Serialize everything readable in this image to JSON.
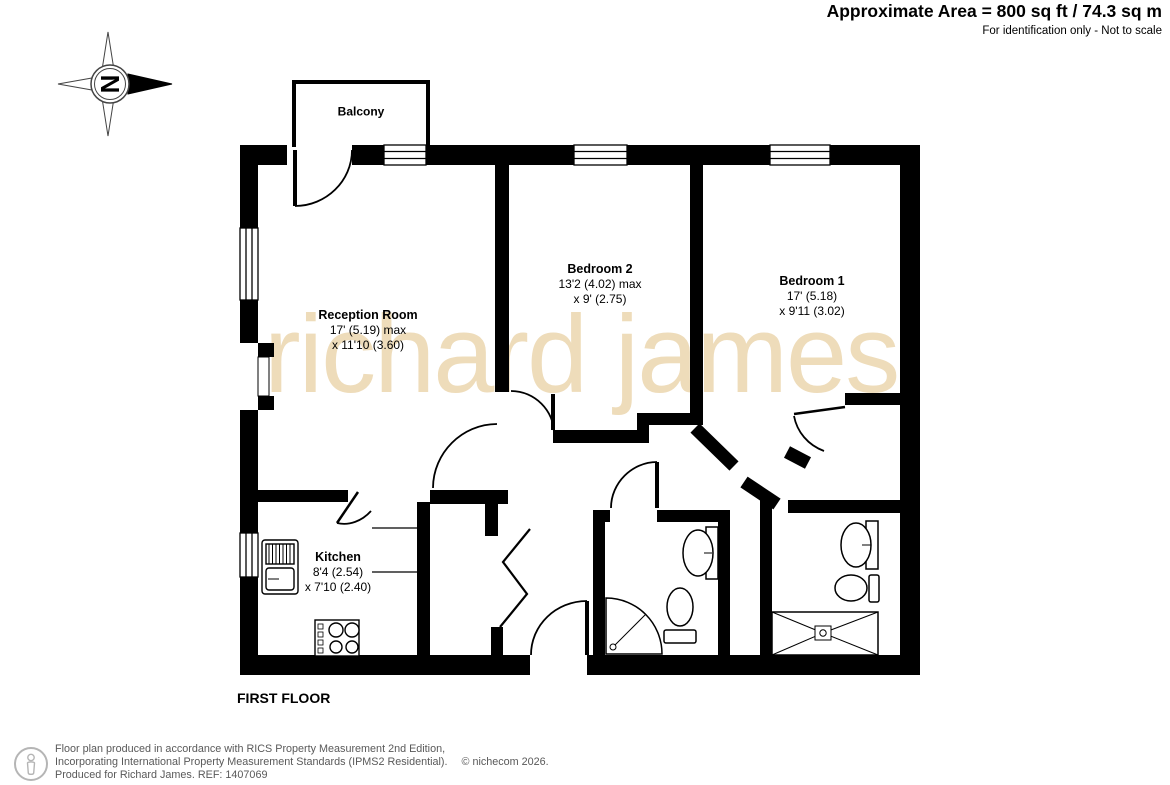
{
  "header": {
    "area_line": "Approximate Area = 800 sq ft / 74.3 sq m",
    "disclaimer": "For identification only - Not to scale"
  },
  "compass": {
    "north_label": "N"
  },
  "watermark": "richard james",
  "floor_label": "FIRST FLOOR",
  "rooms": [
    {
      "name": "Balcony",
      "dim1": "",
      "dim2": ""
    },
    {
      "name": "Reception Room",
      "dim1": "17' (5.19) max",
      "dim2": "x 11'10 (3.60)"
    },
    {
      "name": "Bedroom 2",
      "dim1": "13'2 (4.02) max",
      "dim2": "x 9' (2.75)"
    },
    {
      "name": "Bedroom 1",
      "dim1": "17' (5.18)",
      "dim2": "x 9'11 (3.02)"
    },
    {
      "name": "Kitchen",
      "dim1": "8'4 (2.54)",
      "dim2": "x 7'10 (2.40)"
    }
  ],
  "footer": {
    "line1": "Floor plan produced in accordance with RICS Property Measurement 2nd Edition,",
    "line2": "Incorporating International Property Measurement Standards (IPMS2 Residential).",
    "copyright": "© nichecom 2026.",
    "line3": "Produced for Richard James.   REF:  1407069"
  },
  "colors": {
    "wall": "#000000",
    "watermark": "#eedcba",
    "footer_text": "#595959"
  }
}
